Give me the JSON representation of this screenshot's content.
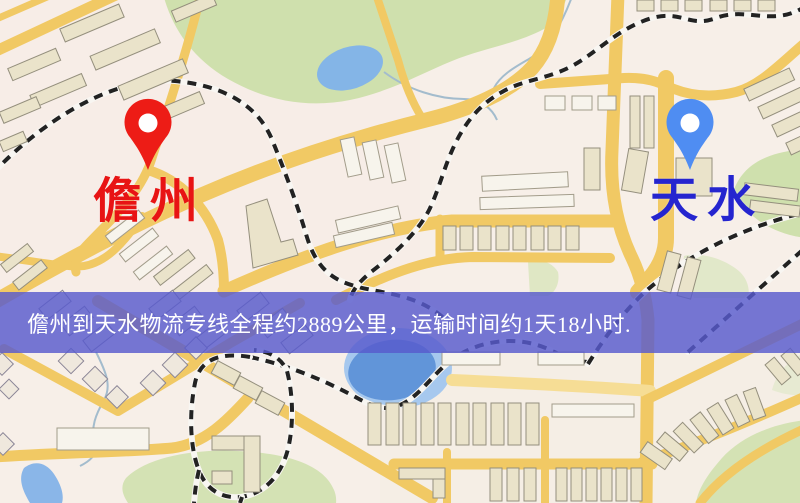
{
  "map": {
    "origin": {
      "name": "儋州",
      "label_color": "#e81414",
      "pin_color": "#ed1c16"
    },
    "destination": {
      "name": "天水",
      "label_color": "#2525cf",
      "pin_color": "#4f8df2"
    },
    "banner": {
      "text": "儋州到天水物流专线全程约2889公里，运输时间约1天18小时.",
      "bg_color": "#585acd",
      "text_color": "#ffffff"
    },
    "route": {
      "distance_text": "约2889公里",
      "duration_text": "约1天18小时"
    },
    "legend_colors": {
      "road": "#f1c964",
      "park": "#cfe0ad",
      "water": "#82b4e6",
      "background": "#f7efe8",
      "railway": "#222222",
      "building": "#eae3ca"
    }
  }
}
